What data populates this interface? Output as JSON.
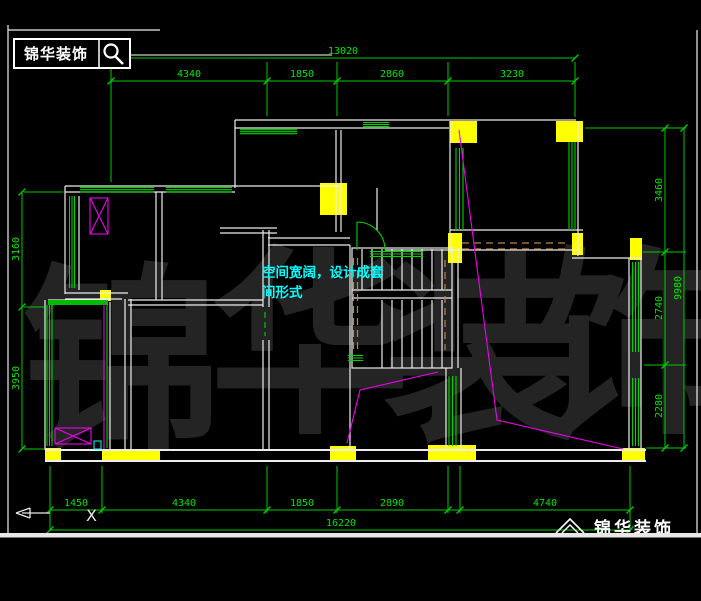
{
  "header": {
    "logo_text": "锦华装饰",
    "search_icon": "magnifier-icon"
  },
  "footer": {
    "logo_text": "锦华装饰",
    "logo_icon": "roof-icon"
  },
  "watermark": {
    "chars": [
      "锦",
      "华",
      "装",
      "饰"
    ]
  },
  "axis": {
    "x_label": "X"
  },
  "annotation": {
    "line1": "空间宽阔，设计成套",
    "line2": "间形式"
  },
  "dims": {
    "top_total": "13020",
    "top": [
      "4340",
      "1850",
      "2860",
      "3230"
    ],
    "bottom": [
      "1450",
      "4340",
      "1850",
      "2890",
      "4740"
    ],
    "bottom_total": "16220",
    "left": [
      "3160",
      "3950"
    ],
    "right": [
      "3460",
      "2740",
      "2280"
    ],
    "right_total": "9980"
  },
  "colors": {
    "background": "#000000",
    "wall_white": "#ededed",
    "dimension_green": "#00e600",
    "window_green": "#00cc00",
    "column_yellow": "#ffff00",
    "fixture_magenta": "#ee00ee",
    "annotation_cyan": "#00ffff",
    "beam_tan": "#b8864b",
    "watermark_gray": "#242424"
  }
}
